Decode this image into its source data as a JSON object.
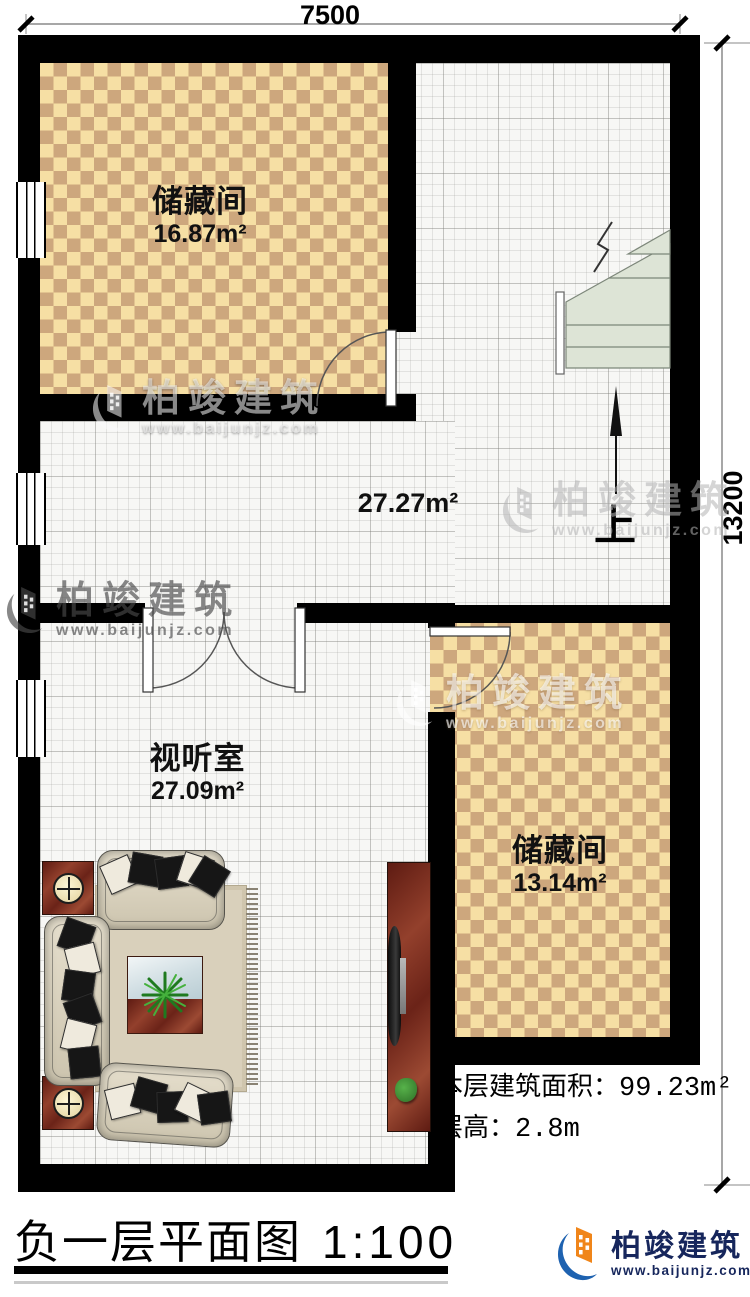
{
  "dimensions": {
    "width_mm": "7500",
    "height_mm": "13200"
  },
  "rooms": [
    {
      "name": "储藏间",
      "area": "16.87m²"
    },
    {
      "area": "27.27m²"
    },
    {
      "name": "视听室",
      "area": "27.09m²"
    },
    {
      "name": "储藏间",
      "area": "13.14m²"
    }
  ],
  "stairs": {
    "up_label": "上"
  },
  "annotations": {
    "floor_area_label": "本层建筑面积：",
    "floor_area_value": "99.23m²",
    "floor_height_label": "层高：",
    "floor_height_value": "2.8m"
  },
  "footer": {
    "title": "负一层平面图",
    "scale": "1:100"
  },
  "brand": {
    "name": "柏竣建筑",
    "url": "www.baijunjz.com"
  },
  "watermark": {
    "name": "柏竣建筑",
    "url": "www.baijunjz.com"
  },
  "colors": {
    "wall": "#000000",
    "checker_light": "#f6dfa4",
    "checker_dark": "#cda77d",
    "stair": "#dde4d6",
    "brand_blue": "#1e62b0",
    "brand_orange": "#f08519",
    "brand_navy": "#16265c"
  }
}
